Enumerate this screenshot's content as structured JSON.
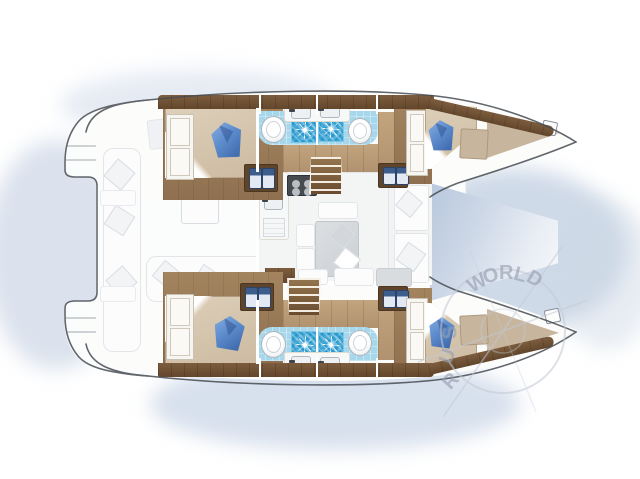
{
  "watermark": {
    "arc_letters": [
      "W",
      "O",
      "R",
      "L",
      "D"
    ],
    "side_letters": [
      "S",
      "U",
      "R"
    ]
  },
  "colors": {
    "wood_dark": "#6f5236",
    "wood_mid": "#9d7e5b",
    "wood_light": "#bb9d78",
    "bed_beige": "#d8c9b2",
    "pillow_blue": "#5d8ccc",
    "tile_blue": "#a7d7eb",
    "shower_mosaic": "#33a4d6",
    "hull_outline": "#474c53",
    "water_glow": "#b9c8de",
    "watermark_gray": "#a8b2c2"
  },
  "features": [
    "double-berth-cabin-aft-port",
    "double-berth-cabin-forward-port",
    "double-berth-cabin-aft-starboard",
    "double-berth-cabin-forward-starboard",
    "shower-compartments-with-mosaic-tile",
    "toilets-and-sinks",
    "galley-with-stove-and-double-sink",
    "salon-dining-table",
    "forward-cockpit-between-bows",
    "aft-cockpit-bench-and-table",
    "stern-swim-platforms",
    "compass-rose-watermark"
  ]
}
